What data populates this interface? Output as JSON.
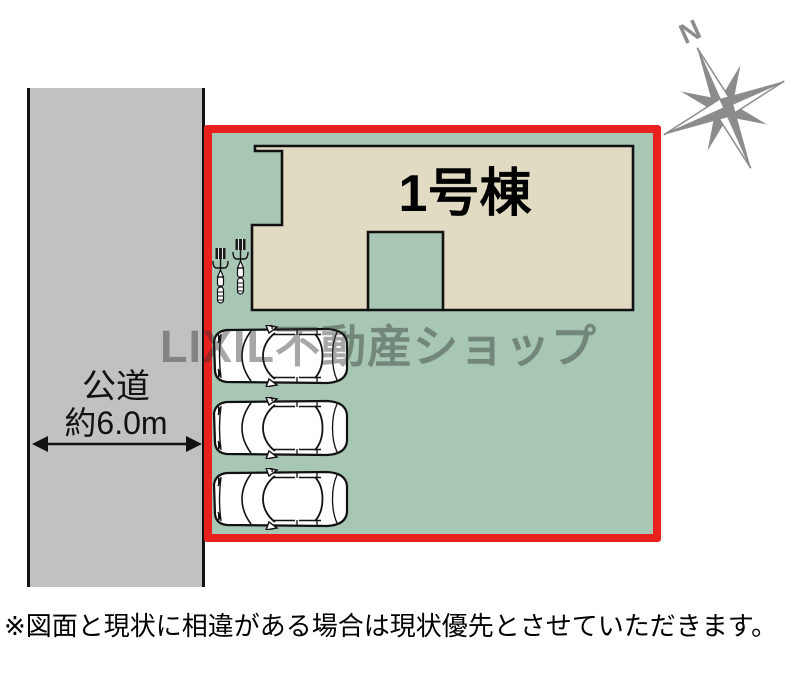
{
  "plan": {
    "building_label": "1号棟",
    "road": {
      "name": "公道",
      "width_label": "約6.0m"
    },
    "watermark_text": "LIXIL不動産ショップ",
    "compass": {
      "north_label": "N"
    },
    "disclaimer": "※図面と現状に相違がある場合は現状優先とさせていただきます。",
    "vehicles": {
      "cars": 3,
      "bicycles": 2
    }
  },
  "colors": {
    "plot_green": "#a8c6b4",
    "building_beige": "#e2dbc4",
    "boundary_red": "#e8211f",
    "road_gray": "#c1c1c1",
    "outline_black": "#111111",
    "compass_gray": "#8c8c8c",
    "watermark_gray": "rgba(40,48,42,0.42)"
  }
}
